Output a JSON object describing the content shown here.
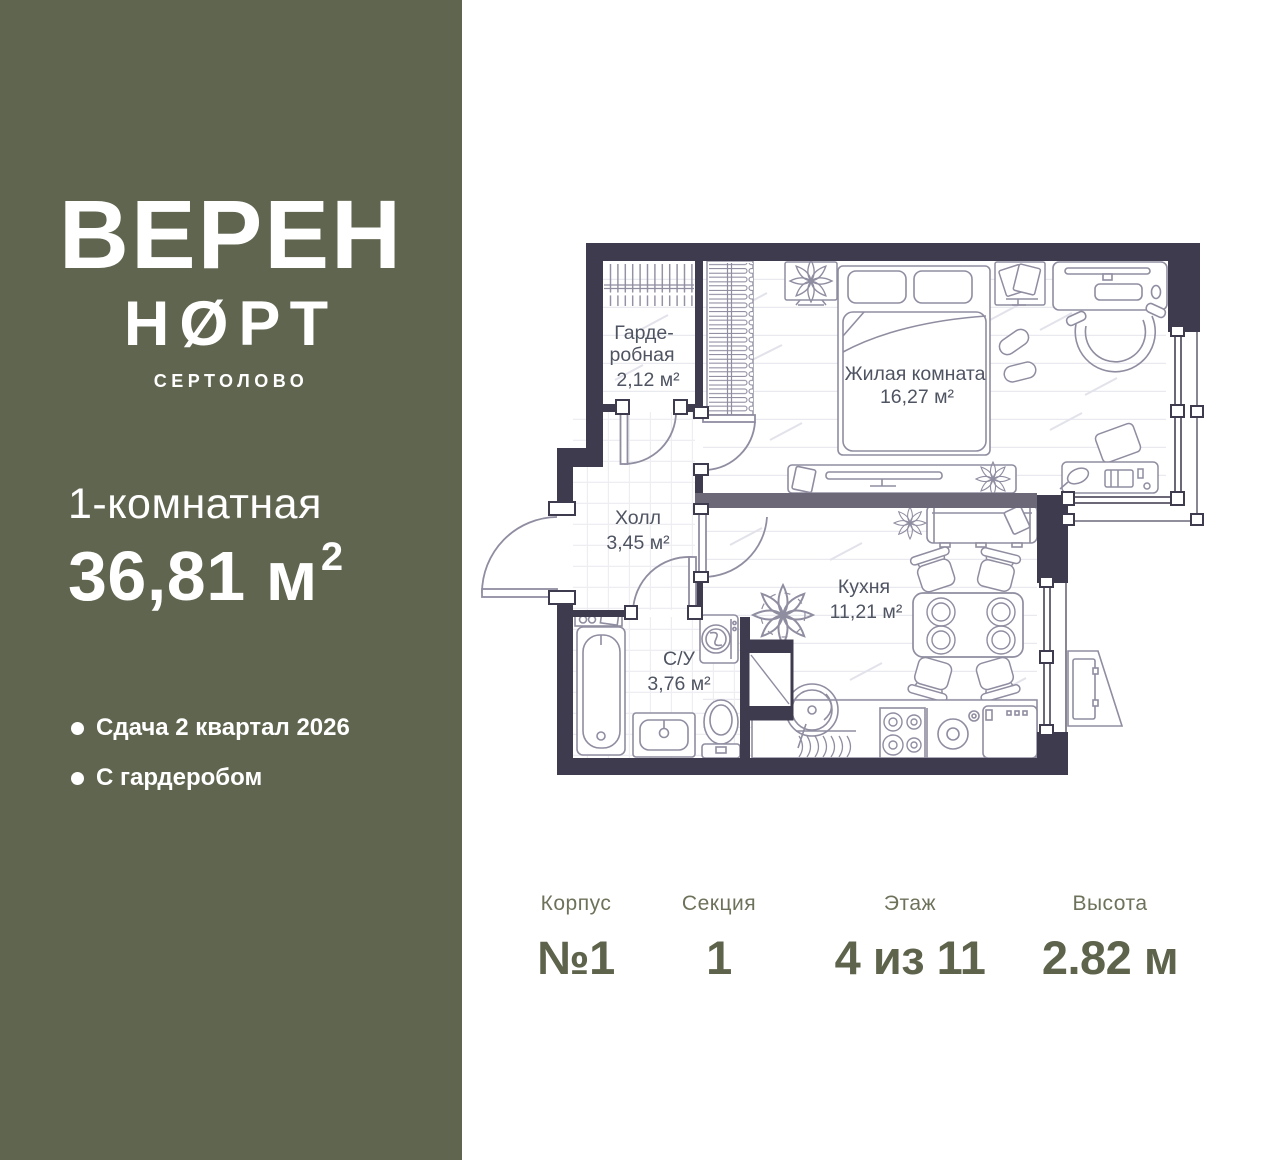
{
  "sidebar": {
    "logo_line1": "ВЕРЕН",
    "logo_line2": "НØРТ",
    "location": "СЕРТОЛОВО",
    "room_type": "1-комнатная",
    "area_value": "36,81 м",
    "area_sup": "2",
    "features": [
      {
        "text": "Сдача 2 квартал 2026"
      },
      {
        "text": "С гардеробом"
      }
    ],
    "colors": {
      "background": "#5f654f",
      "text": "#ffffff"
    }
  },
  "floorplan": {
    "rooms": {
      "wardrobe": {
        "name_line1": "Гарде-",
        "name_line2": "робная",
        "area": "2,12 м²"
      },
      "hall": {
        "name": "Холл",
        "area": "3,45 м²"
      },
      "bathroom": {
        "name": "С/У",
        "area": "3,76 м²"
      },
      "kitchen": {
        "name": "Кухня",
        "area": "11,21 м²"
      },
      "living": {
        "name": "Жилая комната",
        "area": "16,27 м²"
      }
    },
    "colors": {
      "wall": "#3f3b4f",
      "partition": "#6c6878",
      "furniture": "#8f8da0",
      "label": "#4f5462"
    }
  },
  "info": {
    "columns": [
      {
        "label": "Корпус",
        "value": "№1"
      },
      {
        "label": "Секция",
        "value": "1"
      },
      {
        "label": "Этаж",
        "value": "4 из 11"
      },
      {
        "label": "Высота",
        "value": "2.82 м"
      }
    ]
  }
}
